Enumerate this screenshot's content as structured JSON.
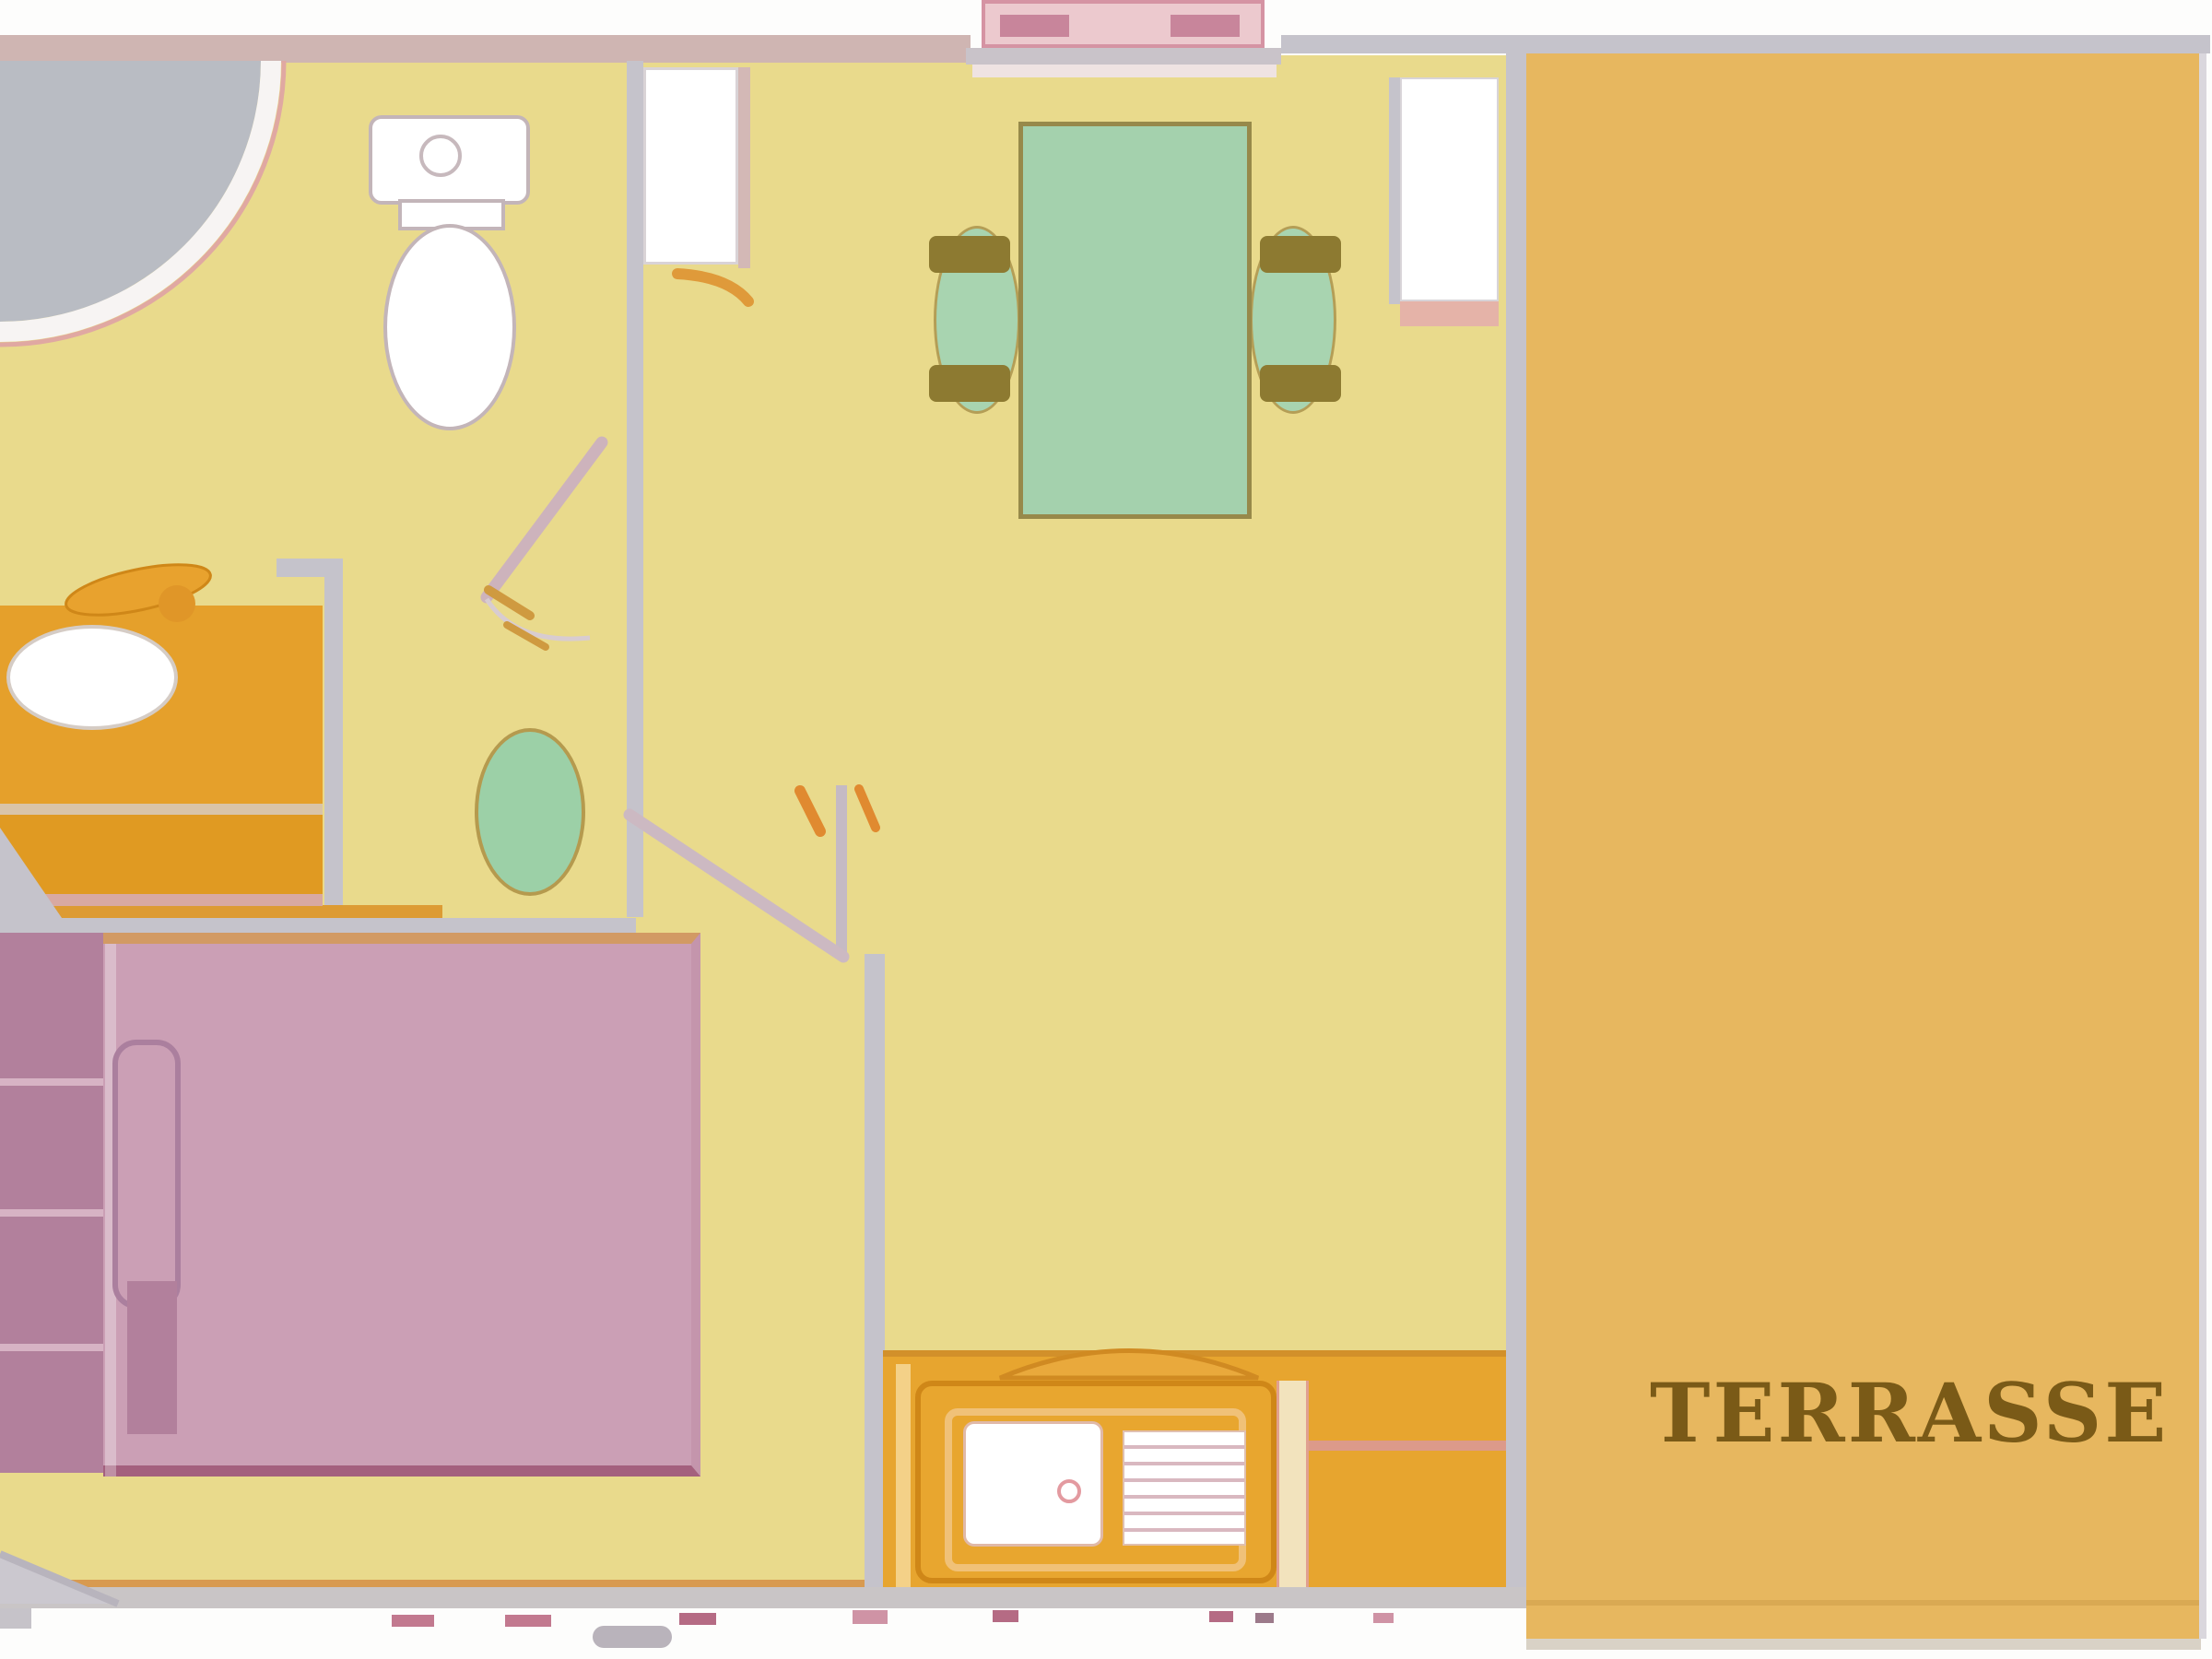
{
  "floorplan": {
    "labels": {
      "terrace": "TERRASSE"
    },
    "colors": {
      "interior_floor": "#e9da8c",
      "terrace_floor": "#e7b75f",
      "wall_gray": "#c5c3cb",
      "wall_pink": "#cfb5b2",
      "table_green": "#a4d1ad",
      "chair_green": "#a8d4b0",
      "chair_arm_olive": "#8d7a31",
      "stool_green": "#9cd0a7",
      "bed_pink": "#cb9fb5",
      "furniture_dark_pink": "#b2809c",
      "vanity_orange": "#e5a02b",
      "counter_orange": "#e7a52f",
      "entrance_pink": "#ecc9ce",
      "step_pink": "#c8859b",
      "shower_gray": "#b9bcc3",
      "label_brown": "#7a5a17",
      "accent_orange": "#df9a3a"
    }
  }
}
